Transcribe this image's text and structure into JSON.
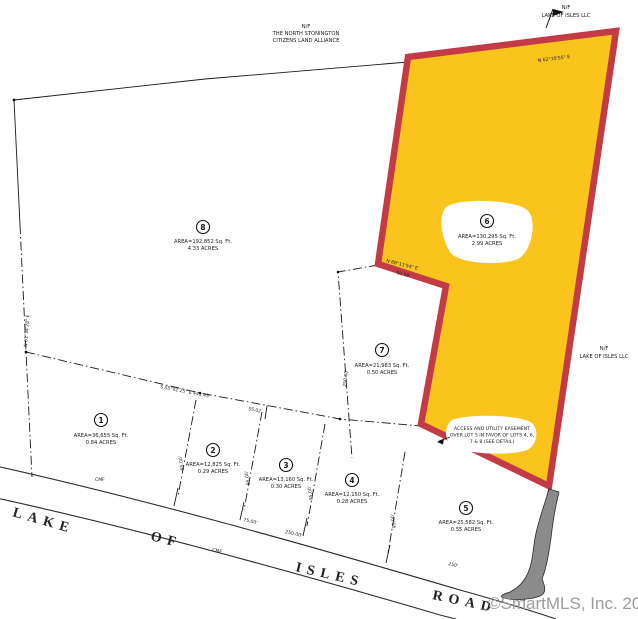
{
  "watermark": "©SmartMLS, Inc.  2024",
  "colors": {
    "highlight_fill": "#FBC41D",
    "highlight_border": "#C33B44",
    "boundary": "#1a1a1a",
    "watermark": "#9b9b9b",
    "driveway": "#8b8b8b"
  },
  "notes": {
    "north_owner": {
      "line1": "N/F",
      "line2": "THE NORTH STONINGTON",
      "line3": "CITIZENS LAND ALLIANCE"
    },
    "northeast_owner": {
      "line1": "N/F",
      "line2": "LAKE OF ISLES LLC"
    },
    "east_owner": {
      "line1": "N/F",
      "line2": "LAKE OF ISLES LLC"
    },
    "easement": {
      "line1": "ACCESS AND UTILITY EASEMENT",
      "line2": "OVER LOT 5 IN FAVOR OF LOTS 4, 6,",
      "line3": "7 & 8 (SEE DETAIL)"
    }
  },
  "road": {
    "word1": "LAKE",
    "word2": "OF",
    "word3": "ISLES",
    "word4": "ROAD"
  },
  "parcels": {
    "p1": {
      "num": "1",
      "area": "AREA=36,655 Sq. Ft.",
      "acres": "0.84 ACRES"
    },
    "p2": {
      "num": "2",
      "area": "AREA=12,825 Sq. Ft.",
      "acres": "0.29 ACRES"
    },
    "p3": {
      "num": "3",
      "area": "AREA=13,160 Sq. Ft.",
      "acres": "0.30 ACRES"
    },
    "p4": {
      "num": "4",
      "area": "AREA=12,150 Sq. Ft.",
      "acres": "0.28 ACRES"
    },
    "p5": {
      "num": "5",
      "area": "AREA=25,582 Sq. Ft.",
      "acres": "0.55 ACRES"
    },
    "p6": {
      "num": "6",
      "area": "AREA=130,295 Sq. Ft.",
      "acres": "2.99 ACRES"
    },
    "p7": {
      "num": "7",
      "area": "AREA=21,983 Sq. Ft.",
      "acres": "0.50 ACRES"
    },
    "p8": {
      "num": "8",
      "area": "AREA=192,852 Sq. Ft.",
      "acres": "4.33 ACRES"
    }
  },
  "dims": {
    "d1": "S 55°02'25\" E  443.43'",
    "d2": "55.02'",
    "d3": "250.00'",
    "d4": "75.00'",
    "d5": "250'",
    "d6": "90.59'",
    "d7": "N 01°34'28\" E",
    "d8": "250.00'",
    "d9": "95.00'",
    "d10": "95.00'",
    "d11": "95.00'",
    "d12": "N 62°30'55\" E",
    "d13": "CMF",
    "d14": "CMF",
    "d15": "95.00'",
    "d16": "N 88°11'54\" E"
  }
}
